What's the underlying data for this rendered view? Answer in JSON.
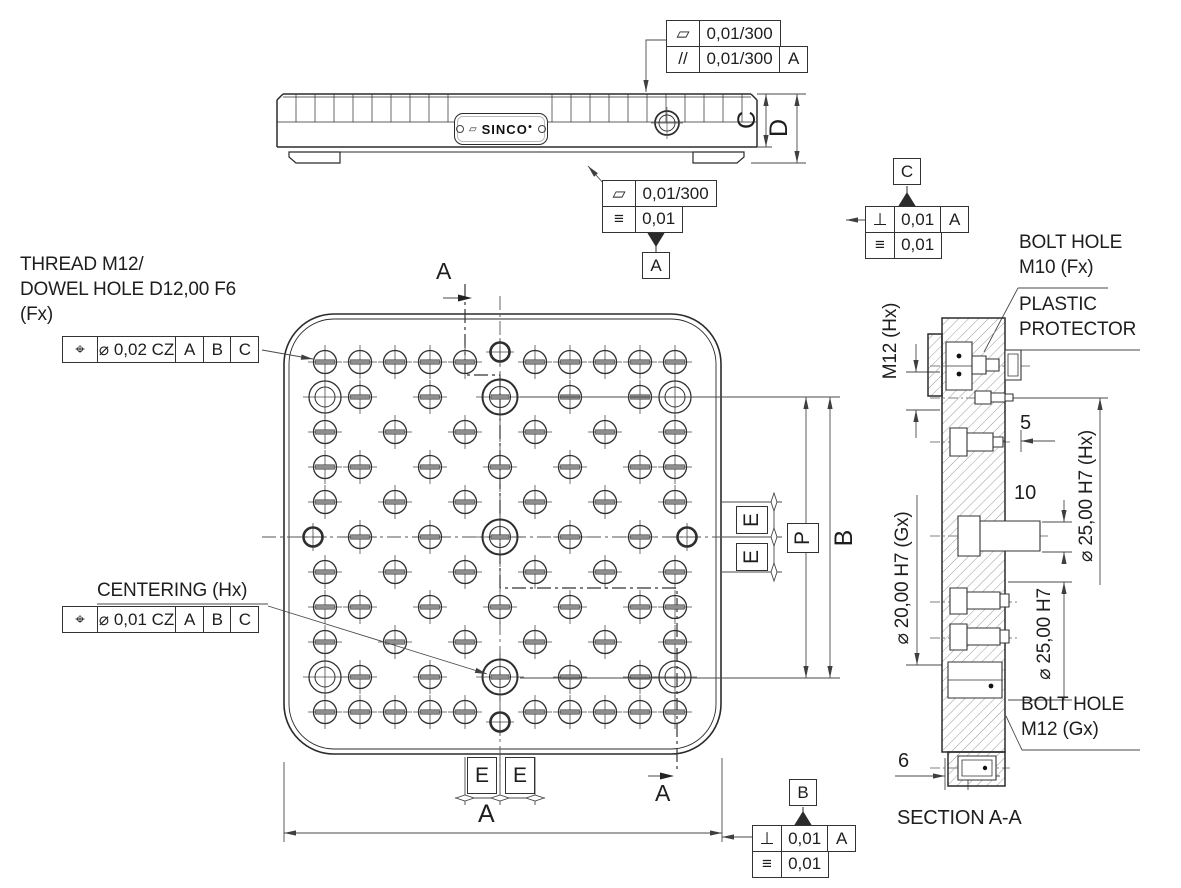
{
  "title_block": {
    "logo": "SINCO"
  },
  "notes": {
    "thread_line1": "THREAD M12/",
    "thread_line2": "DOWEL HOLE D12,00 F6",
    "thread_line3": "(Fx)",
    "centering": "CENTERING (Hx)",
    "bolt_m10_line1": "BOLT HOLE",
    "bolt_m10_line2": "M10 (Fx)",
    "protector_line1": "PLASTIC",
    "protector_line2": "PROTECTOR",
    "bolt_m12_line1": "BOLT HOLE",
    "bolt_m12_line2": "M12 (Gx)",
    "section_title": "SECTION A-A"
  },
  "dims": {
    "overall": "A",
    "pitch_vertical": "B",
    "thickness": "C",
    "height": "D",
    "pitch_boxed": "P",
    "e_right_1": "E",
    "e_right_2": "E",
    "e_bottom_1": "E",
    "e_bottom_2": "E",
    "protrusion_5": "5",
    "protrusion_10": "10",
    "offset_6": "6",
    "m12_thread": "M12 (Hx)",
    "bore_20": "⌀ 20,00 H7 (Gx)",
    "bore_25_hx": "⌀ 25,00 H7 (Hx)",
    "bore_25": "⌀ 25,00 H7",
    "section_arrow_top": "A",
    "section_arrow_bottom": "A"
  },
  "fcf": {
    "top": {
      "r1_sym": "▱",
      "r1_val": "0,01/300",
      "r2_sym": "//",
      "r2_val": "0,01/300",
      "r2_datum": "A"
    },
    "front": {
      "r1_sym": "▱",
      "r1_val": "0,01/300",
      "r2_sym": "≡",
      "r2_val": "0,01",
      "flag": "A"
    },
    "right": {
      "flag": "C",
      "r1_sym": "⊥",
      "r1_val": "0,01",
      "r1_datum": "A",
      "r2_sym": "≡",
      "r2_val": "0,01"
    },
    "bottom": {
      "flag": "B",
      "r1_sym": "⊥",
      "r1_val": "0,01",
      "r1_datum": "A",
      "r2_sym": "≡",
      "r2_val": "0,01"
    },
    "pos_thread": {
      "sym": "⌖",
      "val": "⌀ 0,02 CZ",
      "d1": "A",
      "d2": "B",
      "d3": "C"
    },
    "pos_center": {
      "sym": "⌖",
      "val": "⌀ 0,01 CZ",
      "d1": "A",
      "d2": "B",
      "d3": "C"
    }
  },
  "plan_view": {
    "hole_types": {
      "t": "threaded-hole",
      "d": "thread-dowel-hole",
      "c": "centering-hole",
      "b": "edge-circle"
    },
    "col_x": [
      325,
      360,
      395,
      430,
      465,
      500,
      535,
      570,
      605,
      640,
      675
    ],
    "row_y": [
      362,
      397,
      432,
      467,
      502,
      537,
      572,
      607,
      642,
      677,
      712
    ],
    "pattern": [
      "ttttt.ttttt",
      "dt.t.c.t.td",
      "t.t.t.t.t.t",
      "tt.t.t.t.tt",
      "t.t.t.t.t.t",
      ".t.t.c.t.t.",
      "t.t.t.t.t.t",
      "tt.t.t.t.tt",
      "t.t.t.t.t.t",
      "dt.t.c.t.td",
      "ttttt.ttttt"
    ],
    "edge_circles": [
      {
        "x": 500,
        "y": 352
      },
      {
        "x": 500,
        "y": 722
      },
      {
        "x": 313,
        "y": 537
      },
      {
        "x": 687,
        "y": 537
      }
    ]
  }
}
